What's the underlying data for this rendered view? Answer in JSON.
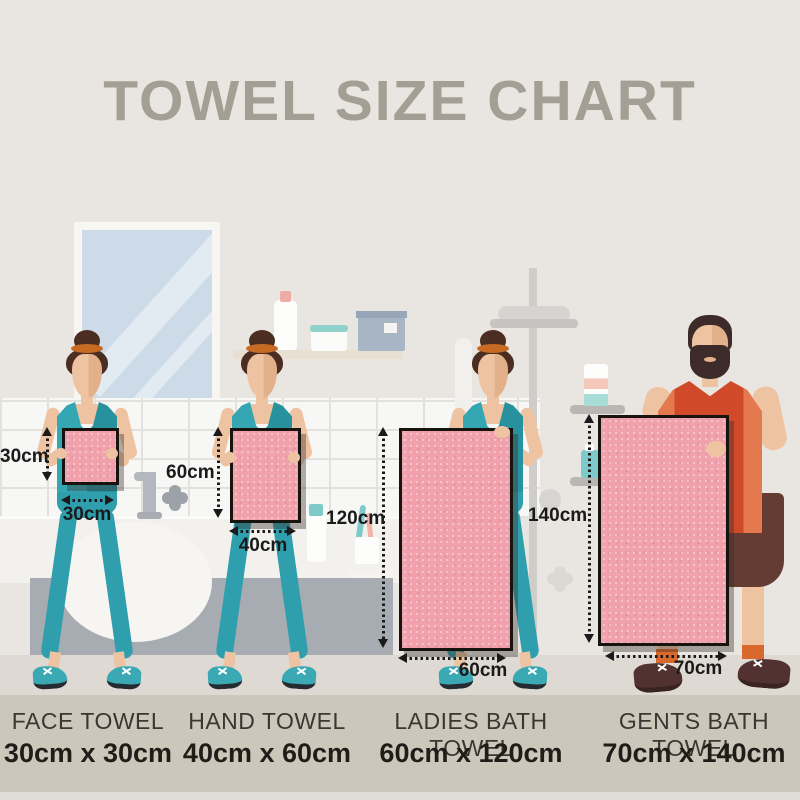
{
  "title": "TOWEL SIZE CHART",
  "towels": [
    {
      "name": "FACE TOWEL",
      "size": "30cm x 30cm",
      "height_label": "30cm",
      "width_label": "30cm"
    },
    {
      "name": "HAND TOWEL",
      "size": "40cm x 60cm",
      "height_label": "60cm",
      "width_label": "40cm"
    },
    {
      "name": "LADIES BATH TOWEL",
      "size": "60cm x 120cm",
      "height_label": "120cm",
      "width_label": "60cm"
    },
    {
      "name": "GENTS BATH TOWEL",
      "size": "70cm x 140cm",
      "height_label": "140cm",
      "width_label": "70cm"
    }
  ],
  "chart_data": {
    "type": "table",
    "title": "TOWEL SIZE CHART",
    "columns": [
      "Towel type",
      "Width (cm)",
      "Height (cm)"
    ],
    "rows": [
      [
        "FACE TOWEL",
        30,
        30
      ],
      [
        "HAND TOWEL",
        40,
        60
      ],
      [
        "LADIES BATH TOWEL",
        60,
        120
      ],
      [
        "GENTS BATH TOWEL",
        70,
        140
      ]
    ]
  },
  "colors": {
    "background": "#e9e5e0",
    "title_gray": "#a39f94",
    "towel_pink": "#f0a1ab",
    "outfit_teal": "#2f9fad",
    "man_shirt_orange": "#d04a2a",
    "caption_band": "#cbc7ba",
    "dimension_text": "#1a1a1a"
  }
}
